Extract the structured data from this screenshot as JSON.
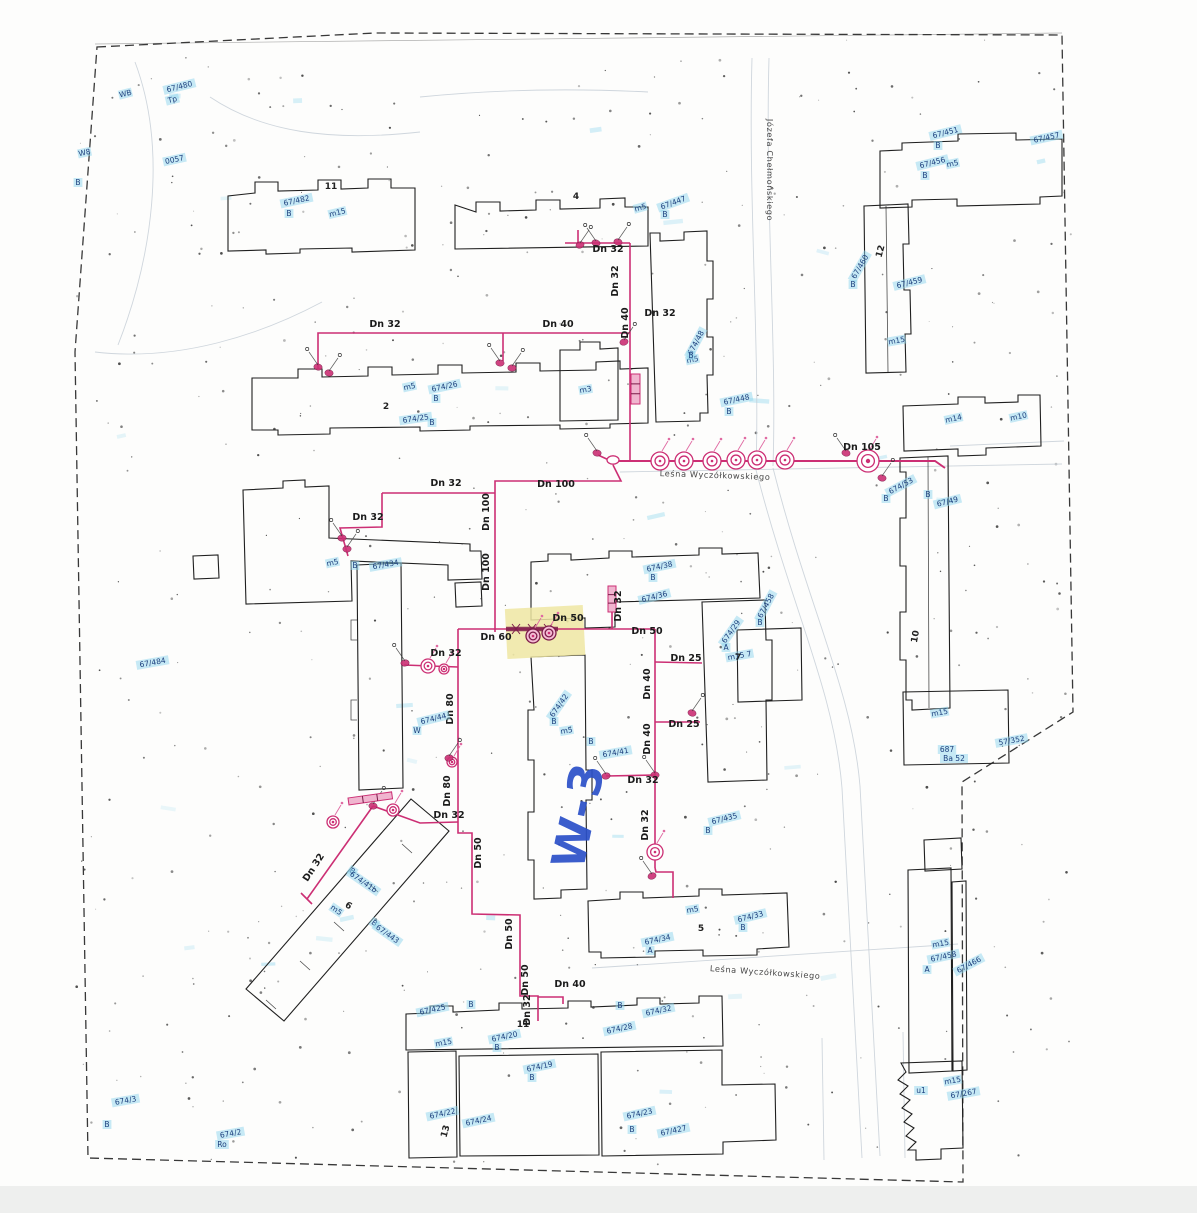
{
  "document_kind": "scanned water-supply site plan",
  "colors": {
    "pipe": "#cc2f74",
    "pipe_dark": "#7c1b49",
    "building": "#1f1f1f",
    "boundary": "#383838",
    "parcel": "#1c3f7d",
    "parcel_highlight": "#8fd6ee",
    "note": "#2b50c8",
    "highlight": "#efe6a2",
    "faint": "#c3ccd4",
    "noise": "#1c1c1c"
  },
  "labels": [
    {
      "t": "Leśna Wyczółkowskiego",
      "x": 715,
      "y": 478,
      "r": 2,
      "k": "street"
    },
    {
      "t": "Leśna Wyczółkowskiego",
      "x": 765,
      "y": 975,
      "r": 4,
      "k": "street"
    },
    {
      "t": "Józefa Chełmońskiego",
      "x": 767,
      "y": 170,
      "r": 90,
      "k": "street"
    },
    {
      "t": "W-3",
      "x": 594,
      "y": 818,
      "r": -78,
      "k": "note"
    },
    {
      "t": "Dn 32",
      "x": 608,
      "y": 252,
      "r": 0,
      "k": "pipe"
    },
    {
      "t": "Dn 32",
      "x": 618,
      "y": 281,
      "r": -90,
      "k": "pipe"
    },
    {
      "t": "Dn 32",
      "x": 660,
      "y": 316,
      "r": 0,
      "k": "pipe"
    },
    {
      "t": "Dn 40",
      "x": 628,
      "y": 323,
      "r": -90,
      "k": "pipe"
    },
    {
      "t": "Dn 32",
      "x": 385,
      "y": 327,
      "r": 0,
      "k": "pipe"
    },
    {
      "t": "Dn 40",
      "x": 558,
      "y": 327,
      "r": 0,
      "k": "pipe"
    },
    {
      "t": "Dn 105",
      "x": 862,
      "y": 450,
      "r": 0,
      "k": "pipe"
    },
    {
      "t": "Dn 100",
      "x": 556,
      "y": 487,
      "r": 0,
      "k": "pipe"
    },
    {
      "t": "Dn 32",
      "x": 446,
      "y": 486,
      "r": 0,
      "k": "pipe"
    },
    {
      "t": "Dn 32",
      "x": 368,
      "y": 520,
      "r": 0,
      "k": "pipe"
    },
    {
      "t": "Dn 100",
      "x": 489,
      "y": 512,
      "r": -90,
      "k": "pipe"
    },
    {
      "t": "Dn 100",
      "x": 489,
      "y": 572,
      "r": -90,
      "k": "pipe"
    },
    {
      "t": "Dn 32",
      "x": 621,
      "y": 606,
      "r": -90,
      "k": "pipe"
    },
    {
      "t": "Dn 50",
      "x": 568,
      "y": 621,
      "r": 0,
      "k": "pipe"
    },
    {
      "t": "Dn 50",
      "x": 647,
      "y": 634,
      "r": 0,
      "k": "pipe"
    },
    {
      "t": "Dn 60",
      "x": 496,
      "y": 640,
      "r": 0,
      "k": "pipe"
    },
    {
      "t": "Dn 32",
      "x": 446,
      "y": 656,
      "r": 0,
      "k": "pipe"
    },
    {
      "t": "Dn 25",
      "x": 686,
      "y": 661,
      "r": 0,
      "k": "pipe"
    },
    {
      "t": "Dn 40",
      "x": 650,
      "y": 684,
      "r": -90,
      "k": "pipe"
    },
    {
      "t": "Dn 80",
      "x": 453,
      "y": 709,
      "r": -90,
      "k": "pipe"
    },
    {
      "t": "Dn 25",
      "x": 684,
      "y": 727,
      "r": 0,
      "k": "pipe"
    },
    {
      "t": "Dn 40",
      "x": 650,
      "y": 739,
      "r": -90,
      "k": "pipe"
    },
    {
      "t": "Dn 80",
      "x": 450,
      "y": 791,
      "r": -90,
      "k": "pipe"
    },
    {
      "t": "Dn 32",
      "x": 449,
      "y": 818,
      "r": 0,
      "k": "pipe"
    },
    {
      "t": "Dn 32",
      "x": 316,
      "y": 869,
      "r": -57,
      "k": "pipe"
    },
    {
      "t": "Dn 32",
      "x": 643,
      "y": 783,
      "r": 0,
      "k": "pipe"
    },
    {
      "t": "Dn 32",
      "x": 648,
      "y": 825,
      "r": -90,
      "k": "pipe"
    },
    {
      "t": "Dn 50",
      "x": 481,
      "y": 853,
      "r": -90,
      "k": "pipe"
    },
    {
      "t": "Dn 50",
      "x": 512,
      "y": 934,
      "r": -90,
      "k": "pipe"
    },
    {
      "t": "Dn 50",
      "x": 528,
      "y": 980,
      "r": -90,
      "k": "pipe"
    },
    {
      "t": "Dn 32",
      "x": 530,
      "y": 1010,
      "r": -90,
      "k": "pipe"
    },
    {
      "t": "Dn 40",
      "x": 570,
      "y": 987,
      "r": 0,
      "k": "pipe"
    },
    {
      "t": "WB",
      "x": 126,
      "y": 96,
      "r": -14,
      "k": "parcel"
    },
    {
      "t": "67/480",
      "x": 180,
      "y": 89,
      "r": -14,
      "k": "parcel"
    },
    {
      "t": "Tp",
      "x": 173,
      "y": 102,
      "r": -14,
      "k": "parcel"
    },
    {
      "t": "W8",
      "x": 85,
      "y": 155,
      "r": -12,
      "k": "parcel"
    },
    {
      "t": "B",
      "x": 78,
      "y": 185,
      "r": 0,
      "k": "parcel"
    },
    {
      "t": "0057",
      "x": 175,
      "y": 162,
      "r": -12,
      "k": "parcel"
    },
    {
      "t": "67/482",
      "x": 297,
      "y": 203,
      "r": -12,
      "k": "parcel"
    },
    {
      "t": "B",
      "x": 289,
      "y": 216,
      "r": 0,
      "k": "parcel"
    },
    {
      "t": "m15",
      "x": 338,
      "y": 215,
      "r": -14,
      "k": "parcel"
    },
    {
      "t": "m5",
      "x": 641,
      "y": 210,
      "r": -16,
      "k": "parcel"
    },
    {
      "t": "67/447",
      "x": 674,
      "y": 205,
      "r": -20,
      "k": "parcel"
    },
    {
      "t": "B",
      "x": 665,
      "y": 217,
      "r": 0,
      "k": "parcel"
    },
    {
      "t": "67/451",
      "x": 946,
      "y": 135,
      "r": -14,
      "k": "parcel"
    },
    {
      "t": "B",
      "x": 938,
      "y": 148,
      "r": 0,
      "k": "parcel"
    },
    {
      "t": "67/457",
      "x": 1047,
      "y": 140,
      "r": -12,
      "k": "parcel"
    },
    {
      "t": "67/456",
      "x": 933,
      "y": 165,
      "r": -14,
      "k": "parcel"
    },
    {
      "t": "B",
      "x": 925,
      "y": 178,
      "r": 0,
      "k": "parcel"
    },
    {
      "t": "m5",
      "x": 953,
      "y": 166,
      "r": -12,
      "k": "parcel"
    },
    {
      "t": "67/460",
      "x": 862,
      "y": 268,
      "r": -60,
      "k": "parcel"
    },
    {
      "t": "B",
      "x": 853,
      "y": 287,
      "r": 0,
      "k": "parcel"
    },
    {
      "t": "67/459",
      "x": 910,
      "y": 285,
      "r": -14,
      "k": "parcel"
    },
    {
      "t": "m15",
      "x": 897,
      "y": 343,
      "r": -10,
      "k": "parcel"
    },
    {
      "t": "m5",
      "x": 410,
      "y": 389,
      "r": -12,
      "k": "parcel"
    },
    {
      "t": "674/26",
      "x": 445,
      "y": 389,
      "r": -12,
      "k": "parcel"
    },
    {
      "t": "B",
      "x": 436,
      "y": 401,
      "r": 0,
      "k": "parcel"
    },
    {
      "t": "674/25",
      "x": 416,
      "y": 421,
      "r": -8,
      "k": "parcel"
    },
    {
      "t": "B",
      "x": 432,
      "y": 425,
      "r": 0,
      "k": "parcel"
    },
    {
      "t": "m3",
      "x": 586,
      "y": 392,
      "r": -10,
      "k": "parcel"
    },
    {
      "t": "m5",
      "x": 693,
      "y": 362,
      "r": -12,
      "k": "parcel"
    },
    {
      "t": "674/48",
      "x": 698,
      "y": 344,
      "r": -62,
      "k": "parcel"
    },
    {
      "t": "B",
      "x": 691,
      "y": 358,
      "r": 0,
      "k": "parcel"
    },
    {
      "t": "67/448",
      "x": 737,
      "y": 402,
      "r": -12,
      "k": "parcel"
    },
    {
      "t": "B",
      "x": 729,
      "y": 414,
      "r": 0,
      "k": "parcel"
    },
    {
      "t": "m14",
      "x": 954,
      "y": 421,
      "r": -12,
      "k": "parcel"
    },
    {
      "t": "m10",
      "x": 1019,
      "y": 419,
      "r": -12,
      "k": "parcel"
    },
    {
      "t": "674/53",
      "x": 902,
      "y": 488,
      "r": -28,
      "k": "parcel"
    },
    {
      "t": "B",
      "x": 886,
      "y": 501,
      "r": 0,
      "k": "parcel"
    },
    {
      "t": "B",
      "x": 928,
      "y": 497,
      "r": 0,
      "k": "parcel"
    },
    {
      "t": "67/49",
      "x": 948,
      "y": 504,
      "r": -14,
      "k": "parcel"
    },
    {
      "t": "674/38",
      "x": 660,
      "y": 569,
      "r": -12,
      "k": "parcel"
    },
    {
      "t": "B",
      "x": 653,
      "y": 580,
      "r": 0,
      "k": "parcel"
    },
    {
      "t": "674/36",
      "x": 655,
      "y": 599,
      "r": -14,
      "k": "parcel"
    },
    {
      "t": "67/458",
      "x": 768,
      "y": 607,
      "r": -62,
      "k": "parcel"
    },
    {
      "t": "B",
      "x": 760,
      "y": 625,
      "r": 0,
      "k": "parcel"
    },
    {
      "t": "674/29",
      "x": 733,
      "y": 633,
      "r": -55,
      "k": "parcel"
    },
    {
      "t": "A",
      "x": 726,
      "y": 650,
      "r": 0,
      "k": "parcel"
    },
    {
      "t": "m15 7",
      "x": 740,
      "y": 658,
      "r": -10,
      "k": "parcel"
    },
    {
      "t": "67/484",
      "x": 153,
      "y": 665,
      "r": -10,
      "k": "parcel"
    },
    {
      "t": "m5",
      "x": 333,
      "y": 565,
      "r": -12,
      "k": "parcel"
    },
    {
      "t": "B",
      "x": 355,
      "y": 568,
      "r": 0,
      "k": "parcel"
    },
    {
      "t": "67/434",
      "x": 386,
      "y": 567,
      "r": -10,
      "k": "parcel"
    },
    {
      "t": "674/44",
      "x": 434,
      "y": 721,
      "r": -14,
      "k": "parcel"
    },
    {
      "t": "W",
      "x": 417,
      "y": 733,
      "r": 0,
      "k": "parcel"
    },
    {
      "t": "674/42",
      "x": 561,
      "y": 707,
      "r": -55,
      "k": "parcel"
    },
    {
      "t": "B",
      "x": 554,
      "y": 724,
      "r": 0,
      "k": "parcel"
    },
    {
      "t": "m5",
      "x": 567,
      "y": 733,
      "r": -10,
      "k": "parcel"
    },
    {
      "t": "674/41",
      "x": 616,
      "y": 755,
      "r": -10,
      "k": "parcel"
    },
    {
      "t": "B",
      "x": 591,
      "y": 744,
      "r": 0,
      "k": "parcel"
    },
    {
      "t": "B",
      "x": 351,
      "y": 873,
      "r": 35,
      "k": "parcel"
    },
    {
      "t": "674/41b",
      "x": 362,
      "y": 884,
      "r": 35,
      "k": "parcel"
    },
    {
      "t": "m5",
      "x": 335,
      "y": 912,
      "r": 35,
      "k": "parcel"
    },
    {
      "t": "B",
      "x": 373,
      "y": 925,
      "r": 35,
      "k": "parcel"
    },
    {
      "t": "67/443",
      "x": 386,
      "y": 936,
      "r": 35,
      "k": "parcel"
    },
    {
      "t": "67/435",
      "x": 725,
      "y": 821,
      "r": -14,
      "k": "parcel"
    },
    {
      "t": "B",
      "x": 708,
      "y": 833,
      "r": 0,
      "k": "parcel"
    },
    {
      "t": "674/34",
      "x": 658,
      "y": 942,
      "r": -12,
      "k": "parcel"
    },
    {
      "t": "A",
      "x": 650,
      "y": 953,
      "r": 0,
      "k": "parcel"
    },
    {
      "t": "m5",
      "x": 693,
      "y": 912,
      "r": -10,
      "k": "parcel"
    },
    {
      "t": "674/33",
      "x": 751,
      "y": 919,
      "r": -14,
      "k": "parcel"
    },
    {
      "t": "B",
      "x": 743,
      "y": 930,
      "r": 0,
      "k": "parcel"
    },
    {
      "t": "m15",
      "x": 940,
      "y": 715,
      "r": -10,
      "k": "parcel"
    },
    {
      "t": "687",
      "x": 947,
      "y": 752,
      "r": 0,
      "k": "parcel"
    },
    {
      "t": "Ba 52",
      "x": 954,
      "y": 761,
      "r": 0,
      "k": "parcel"
    },
    {
      "t": "57/352",
      "x": 1012,
      "y": 743,
      "r": -10,
      "k": "parcel"
    },
    {
      "t": "67/425",
      "x": 433,
      "y": 1012,
      "r": -12,
      "k": "parcel"
    },
    {
      "t": "B",
      "x": 471,
      "y": 1007,
      "r": 0,
      "k": "parcel"
    },
    {
      "t": "m15",
      "x": 444,
      "y": 1045,
      "r": -10,
      "k": "parcel"
    },
    {
      "t": "674/20",
      "x": 505,
      "y": 1039,
      "r": -12,
      "k": "parcel"
    },
    {
      "t": "B",
      "x": 497,
      "y": 1050,
      "r": 0,
      "k": "parcel"
    },
    {
      "t": "674/28",
      "x": 620,
      "y": 1031,
      "r": -12,
      "k": "parcel"
    },
    {
      "t": "B",
      "x": 620,
      "y": 1008,
      "r": 0,
      "k": "parcel"
    },
    {
      "t": "674/32",
      "x": 659,
      "y": 1013,
      "r": -12,
      "k": "parcel"
    },
    {
      "t": "674/19",
      "x": 540,
      "y": 1069,
      "r": -12,
      "k": "parcel"
    },
    {
      "t": "B",
      "x": 532,
      "y": 1080,
      "r": 0,
      "k": "parcel"
    },
    {
      "t": "674/22",
      "x": 443,
      "y": 1116,
      "r": -12,
      "k": "parcel"
    },
    {
      "t": "674/24",
      "x": 479,
      "y": 1123,
      "r": -12,
      "k": "parcel"
    },
    {
      "t": "674/23",
      "x": 640,
      "y": 1116,
      "r": -12,
      "k": "parcel"
    },
    {
      "t": "B",
      "x": 632,
      "y": 1132,
      "r": 0,
      "k": "parcel"
    },
    {
      "t": "67/427",
      "x": 674,
      "y": 1133,
      "r": -12,
      "k": "parcel"
    },
    {
      "t": "m15",
      "x": 941,
      "y": 946,
      "r": -10,
      "k": "parcel"
    },
    {
      "t": "67/458",
      "x": 944,
      "y": 959,
      "r": -12,
      "k": "parcel"
    },
    {
      "t": "A",
      "x": 927,
      "y": 972,
      "r": 0,
      "k": "parcel"
    },
    {
      "t": "67/466",
      "x": 970,
      "y": 967,
      "r": -28,
      "k": "parcel"
    },
    {
      "t": "u1",
      "x": 921,
      "y": 1093,
      "r": 0,
      "k": "parcel"
    },
    {
      "t": "m15",
      "x": 953,
      "y": 1083,
      "r": -10,
      "k": "parcel"
    },
    {
      "t": "67/267",
      "x": 964,
      "y": 1096,
      "r": -10,
      "k": "parcel"
    },
    {
      "t": "674/3",
      "x": 126,
      "y": 1103,
      "r": -10,
      "k": "parcel"
    },
    {
      "t": "B",
      "x": 107,
      "y": 1127,
      "r": 0,
      "k": "parcel"
    },
    {
      "t": "674/2",
      "x": 231,
      "y": 1136,
      "r": -10,
      "k": "parcel"
    },
    {
      "t": "Ro",
      "x": 222,
      "y": 1147,
      "r": 0,
      "k": "parcel"
    },
    {
      "t": "11",
      "x": 331,
      "y": 189,
      "r": 0,
      "k": "bnum"
    },
    {
      "t": "2",
      "x": 386,
      "y": 409,
      "r": 0,
      "k": "bnum"
    },
    {
      "t": "4",
      "x": 576,
      "y": 199,
      "r": 0,
      "k": "bnum"
    },
    {
      "t": "12",
      "x": 883,
      "y": 252,
      "r": -75,
      "k": "bnum"
    },
    {
      "t": "10",
      "x": 918,
      "y": 637,
      "r": -80,
      "k": "bnum"
    },
    {
      "t": "6",
      "x": 347,
      "y": 908,
      "r": 33,
      "k": "bnum"
    },
    {
      "t": "5",
      "x": 701,
      "y": 931,
      "r": 0,
      "k": "bnum"
    },
    {
      "t": "11",
      "x": 523,
      "y": 1027,
      "r": 0,
      "k": "bnum"
    },
    {
      "t": "13",
      "x": 448,
      "y": 1132,
      "r": -75,
      "k": "bnum"
    },
    {
      "t": "7",
      "x": 738,
      "y": 660,
      "r": 0,
      "k": "bnum"
    }
  ],
  "hydrants": [
    {
      "x": 660,
      "y": 461,
      "r": 9,
      "t": "s"
    },
    {
      "x": 684,
      "y": 461,
      "r": 9,
      "t": "s"
    },
    {
      "x": 712,
      "y": 461,
      "r": 9,
      "t": "s"
    },
    {
      "x": 736,
      "y": 460,
      "r": 9,
      "t": "s"
    },
    {
      "x": 757,
      "y": 460,
      "r": 9,
      "t": "s"
    },
    {
      "x": 785,
      "y": 460,
      "r": 9,
      "t": "s"
    },
    {
      "x": 868,
      "y": 461,
      "r": 11,
      "t": "d"
    },
    {
      "x": 655,
      "y": 852,
      "r": 8,
      "t": "s"
    },
    {
      "x": 428,
      "y": 666,
      "r": 7,
      "t": "s"
    },
    {
      "x": 444,
      "y": 669,
      "r": 5,
      "t": "s"
    },
    {
      "x": 533,
      "y": 636,
      "r": 7,
      "t": "k"
    },
    {
      "x": 549,
      "y": 633,
      "r": 7,
      "t": "k"
    },
    {
      "x": 452,
      "y": 762,
      "r": 5,
      "t": "s"
    },
    {
      "x": 333,
      "y": 822,
      "r": 6,
      "t": "s"
    },
    {
      "x": 393,
      "y": 810,
      "r": 6,
      "t": "s"
    },
    {
      "x": 613,
      "y": 460,
      "r": 6,
      "t": "n"
    }
  ],
  "connections": [
    {
      "x": 580,
      "y": 245
    },
    {
      "x": 596,
      "y": 243
    },
    {
      "x": 618,
      "y": 242
    },
    {
      "x": 318,
      "y": 367
    },
    {
      "x": 329,
      "y": 373
    },
    {
      "x": 500,
      "y": 363
    },
    {
      "x": 512,
      "y": 368
    },
    {
      "x": 342,
      "y": 538
    },
    {
      "x": 347,
      "y": 549
    },
    {
      "x": 405,
      "y": 663
    },
    {
      "x": 449,
      "y": 758
    },
    {
      "x": 606,
      "y": 776
    },
    {
      "x": 624,
      "y": 342
    },
    {
      "x": 652,
      "y": 876
    },
    {
      "x": 692,
      "y": 713
    },
    {
      "x": 846,
      "y": 453
    },
    {
      "x": 882,
      "y": 478
    },
    {
      "x": 597,
      "y": 453
    },
    {
      "x": 373,
      "y": 806
    },
    {
      "x": 655,
      "y": 775
    }
  ],
  "valve_bars": [
    {
      "x": 348,
      "y": 798,
      "w": 44,
      "h": 7,
      "r": -8
    },
    {
      "x": 608,
      "y": 586,
      "w": 8,
      "h": 26,
      "r": 0
    },
    {
      "x": 631,
      "y": 374,
      "w": 9,
      "h": 30,
      "r": 0
    }
  ]
}
